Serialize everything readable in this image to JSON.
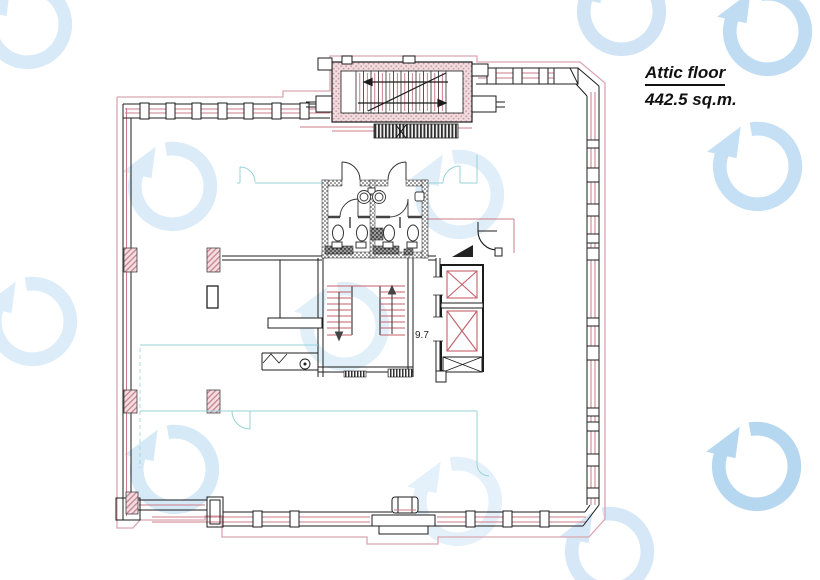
{
  "title": {
    "line1": "Attic floor",
    "line2": "442.5 sq.m."
  },
  "labels": {
    "stair_width": "9.7"
  },
  "colors": {
    "wall_black": "#1c1c1c",
    "outline_pink": "#dba6b0",
    "accent_red": "#c2606a",
    "partition_cyan": "#97d3d6",
    "watermark_blue": "#bcd9f0",
    "pier_hatch_pink": "#cf9aa3",
    "paper": "#ffffff"
  },
  "watermark": {
    "icon": "rotate-arrow-logo-icon",
    "count": 12
  }
}
